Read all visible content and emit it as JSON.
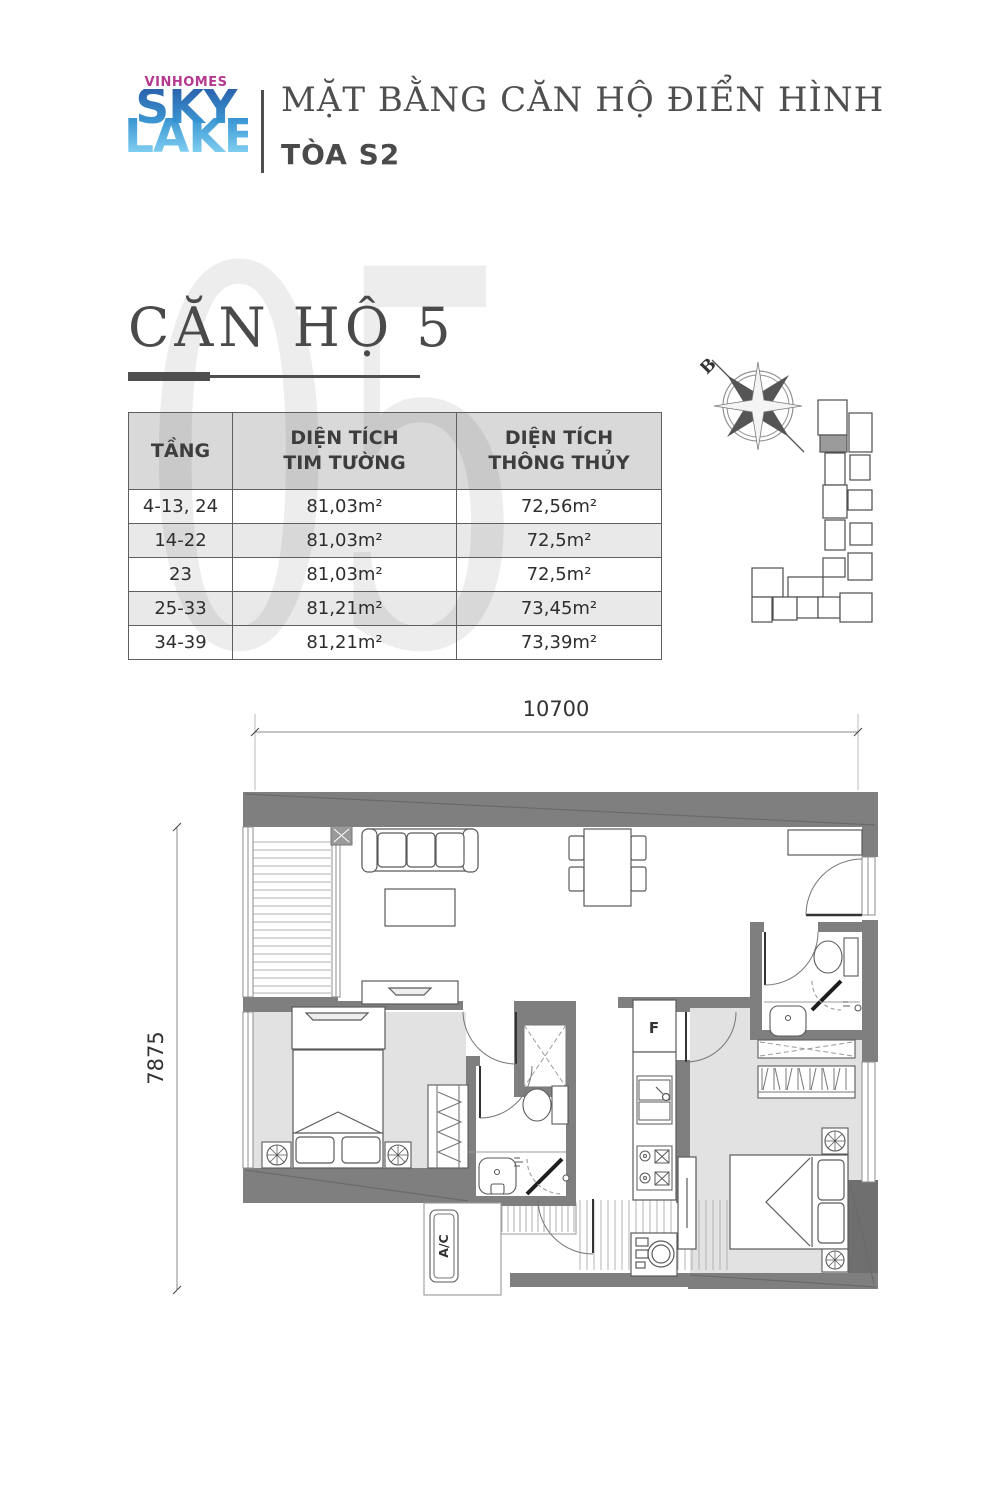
{
  "header": {
    "logo": {
      "brand": "VINHOMES",
      "word1": "SKY",
      "word2": "LAKE"
    },
    "title": "MẶT BẰNG CĂN HỘ ĐIỂN HÌNH",
    "subtitle": "TÒA S2"
  },
  "unit": {
    "watermark": "05",
    "heading": "CĂN HỘ 5"
  },
  "area_table": {
    "columns": [
      [
        "TẦNG"
      ],
      [
        "DIỆN TÍCH",
        "TIM TƯỜNG"
      ],
      [
        "DIỆN TÍCH",
        "THÔNG THỦY"
      ]
    ],
    "rows": [
      [
        "4-13, 24",
        "81,03m²",
        "72,56m²"
      ],
      [
        "14-22",
        "81,03m²",
        "72,5m²"
      ],
      [
        "23",
        "81,03m²",
        "72,5m²"
      ],
      [
        "25-33",
        "81,21m²",
        "73,45m²"
      ],
      [
        "34-39",
        "81,21m²",
        "73,39m²"
      ]
    ]
  },
  "site_key": {
    "north_label": "B",
    "highlighted_unit_color": "#9b9b9b"
  },
  "floor_plan": {
    "dim_width": "10700",
    "dim_height": "7875",
    "fridge_label": "F",
    "ac_label": "A/C"
  },
  "colors": {
    "brand_magenta": "#b5398f",
    "sky_blue_top": "#2a63ad",
    "lake_blue_bottom": "#7ed0f2",
    "heading_gray": "#4a4a4a",
    "watermark_gray": "#ededed",
    "wall_gray": "#7f7f7f",
    "bedroom_floor_gray": "#e2e2e2"
  }
}
